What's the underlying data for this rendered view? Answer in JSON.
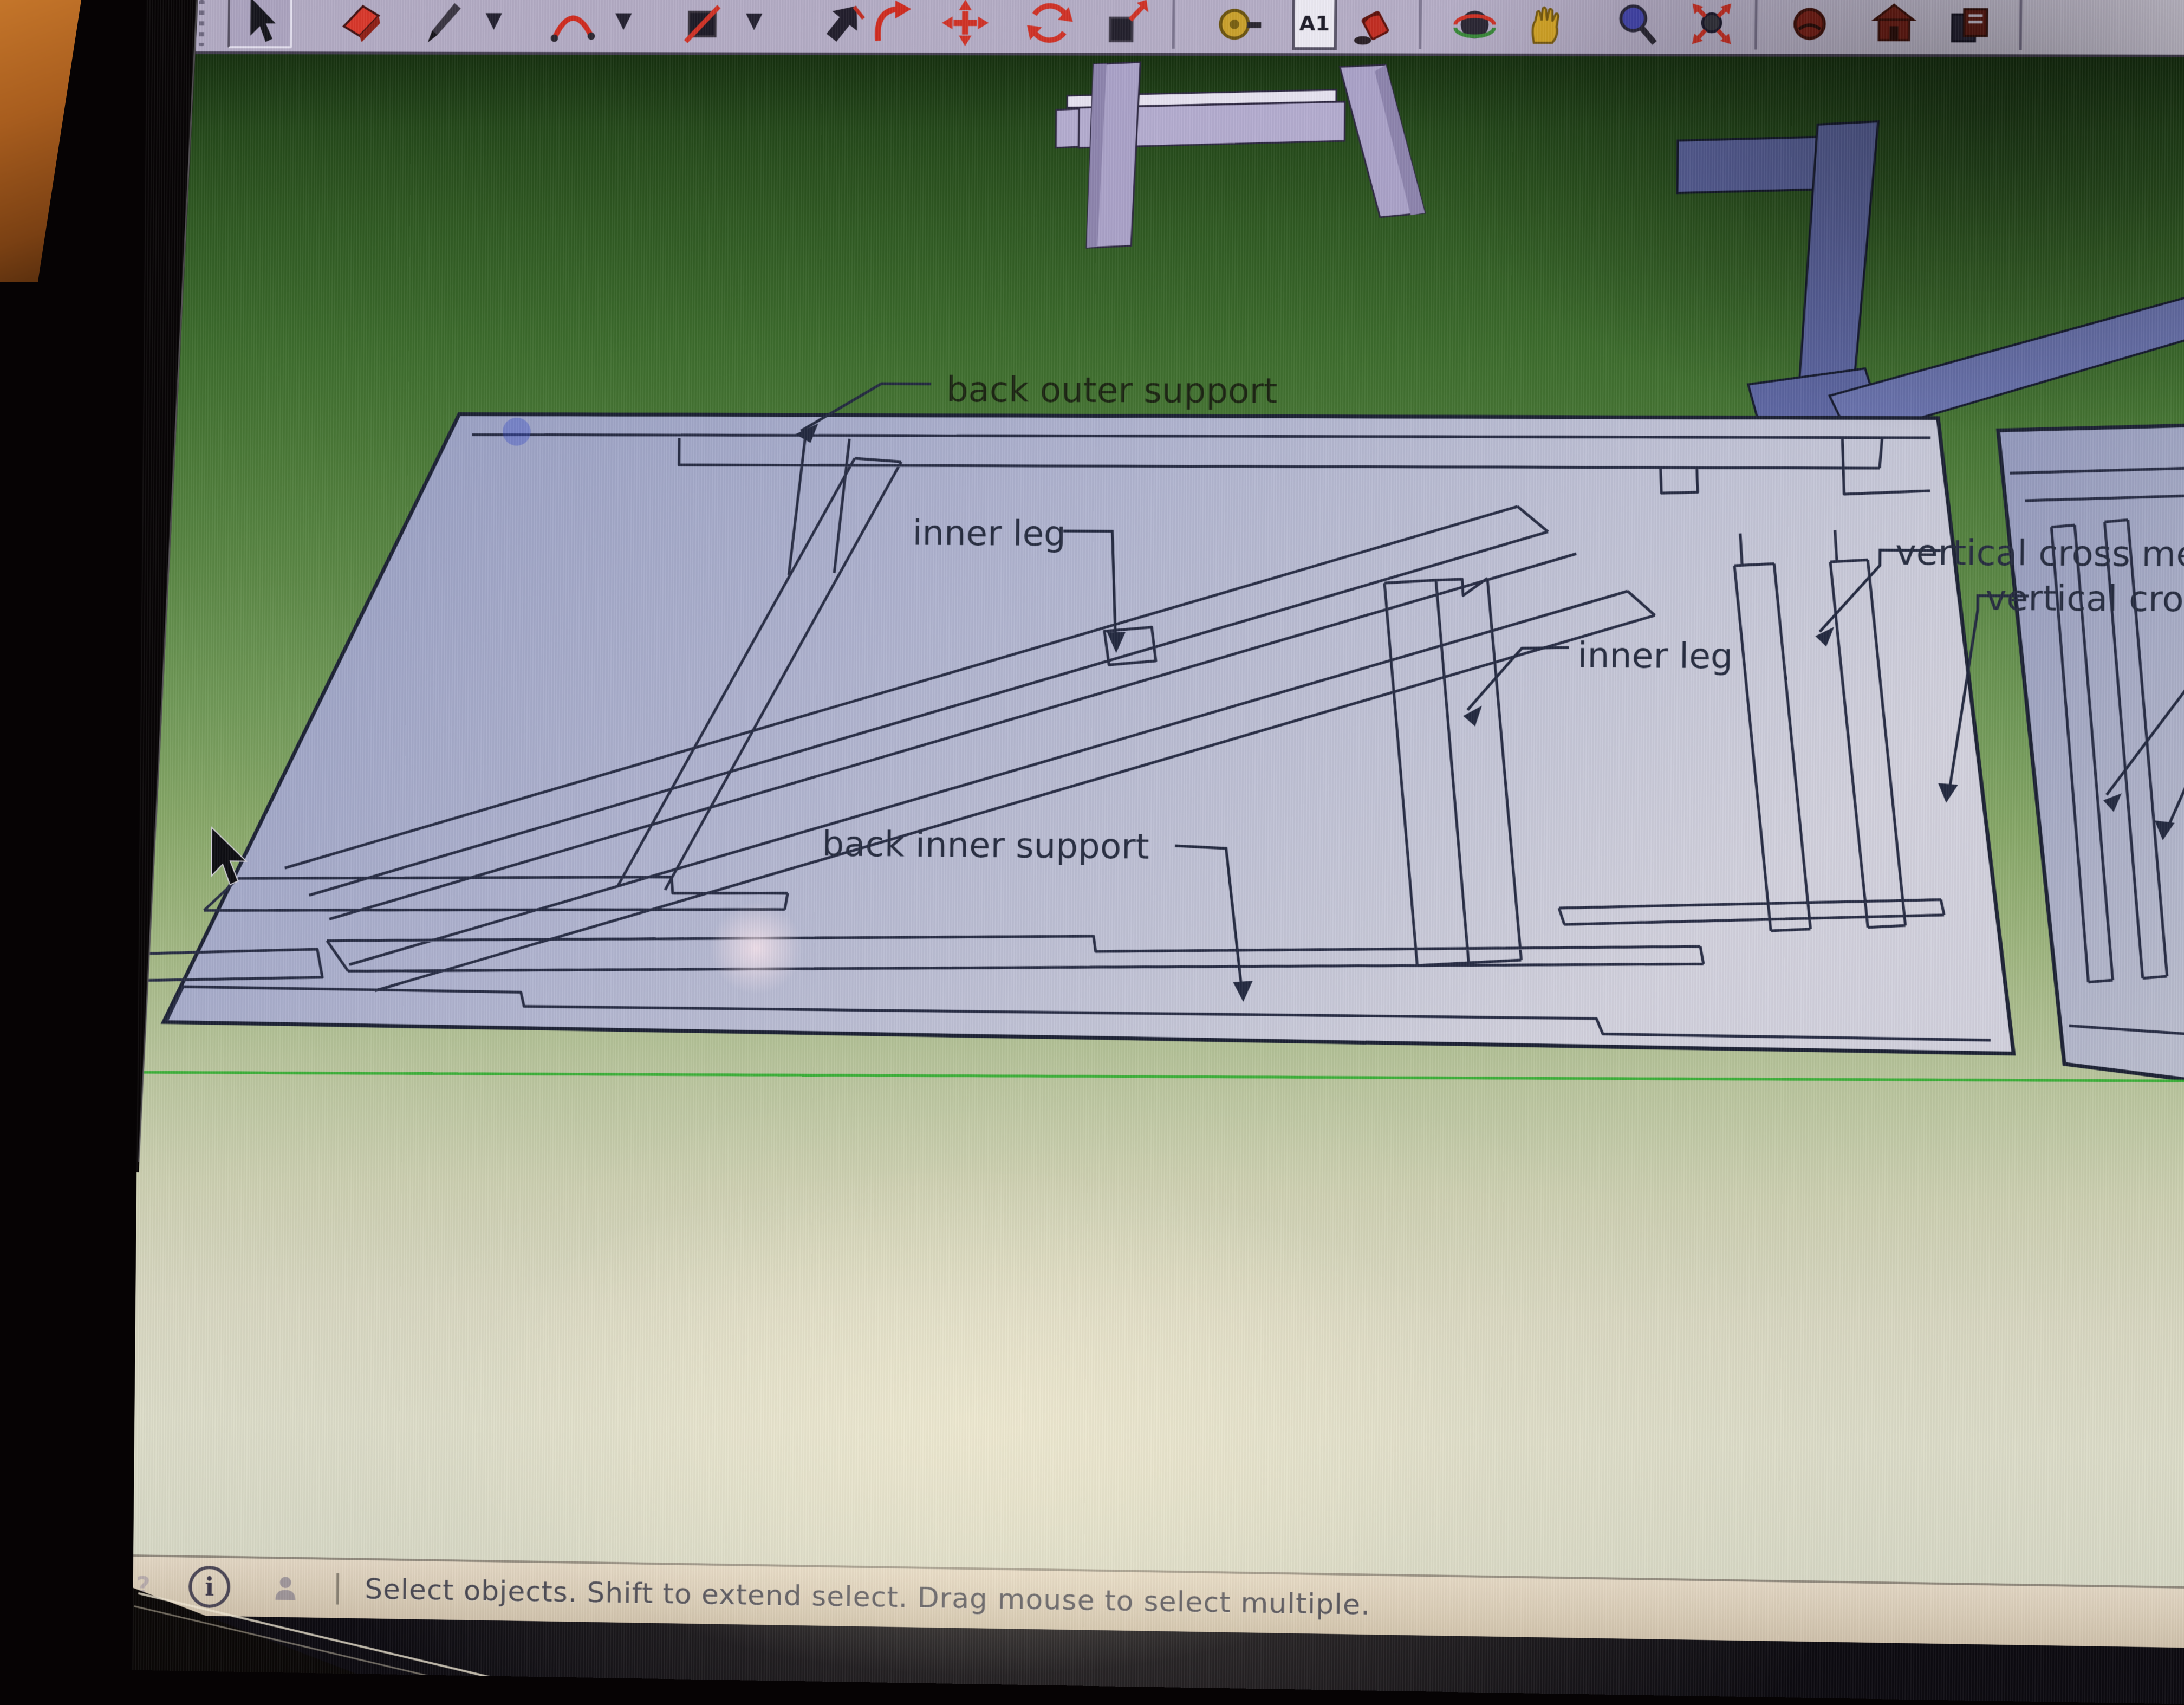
{
  "toolbar": {
    "dimension_label": "A1",
    "tools": [
      {
        "name": "select",
        "icon": "select-cursor-icon",
        "active": true
      },
      {
        "name": "eraser",
        "icon": "eraser-icon"
      },
      {
        "name": "line",
        "icon": "pencil-icon",
        "has_dropdown": true
      },
      {
        "name": "arc",
        "icon": "arc-icon",
        "has_dropdown": true
      },
      {
        "name": "rectangle",
        "icon": "rectangle-icon",
        "has_dropdown": true
      },
      {
        "name": "push-pull",
        "icon": "push-pull-icon"
      },
      {
        "name": "follow-me",
        "icon": "follow-me-icon"
      },
      {
        "name": "move",
        "icon": "move-icon"
      },
      {
        "name": "rotate",
        "icon": "rotate-icon"
      },
      {
        "name": "scale",
        "icon": "scale-icon"
      },
      {
        "name": "tape-measure",
        "icon": "tape-measure-icon"
      },
      {
        "name": "dimension",
        "icon": "dimension-icon"
      },
      {
        "name": "paint-bucket",
        "icon": "paint-bucket-icon"
      },
      {
        "name": "orbit",
        "icon": "orbit-icon"
      },
      {
        "name": "pan",
        "icon": "pan-hand-icon"
      },
      {
        "name": "zoom",
        "icon": "zoom-icon"
      },
      {
        "name": "zoom-extents",
        "icon": "zoom-extents-icon"
      },
      {
        "name": "shadows",
        "icon": "shadows-icon"
      },
      {
        "name": "warehouse",
        "icon": "warehouse-icon"
      },
      {
        "name": "components",
        "icon": "components-icon"
      }
    ]
  },
  "model_labels": {
    "back_outer_support": "back outer support",
    "inner_leg_left": "inner leg",
    "inner_leg_right": "inner leg",
    "back_inner_support": "back inner support",
    "vertical_cross_member": "vertical cross mem",
    "vertical_cross_member_2": "vertical cro"
  },
  "status_bar": {
    "message": "Select objects. Shift to extend select. Drag mouse to select multiple.",
    "info_glyph": "i",
    "help_glyph": "?"
  },
  "colors": {
    "canvas_green": "#3c6b2c",
    "panel_fill": "#aeb2ce",
    "panel2_fill": "#a2a7c2",
    "outline": "#272c44",
    "axis_green": "#2fae2f",
    "toolbar_bg": "#b2aac3",
    "status_bg": "#d9cdbb",
    "label_text": "#262c40"
  }
}
